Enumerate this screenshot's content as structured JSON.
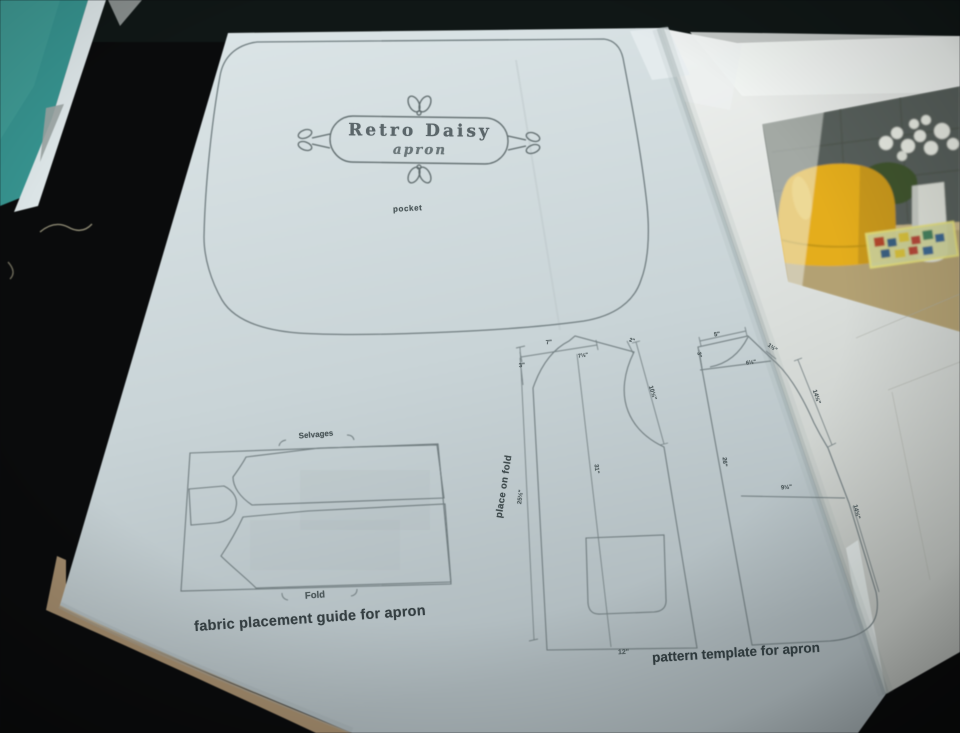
{
  "colors": {
    "teal_table": "#379490",
    "dark_cloth": "#0a0b0c",
    "page_paper": "#ccd7da",
    "right_page_paper": "#e6e9e6",
    "diagram_line": "#6d797c",
    "ink_text": "#39454a",
    "book_cover_tan": "#a89070",
    "bread_bin_yellow": "#e4ad1e",
    "photo_wall_grey": "#59605b",
    "photo_counter_tan": "#b3a173"
  },
  "page": {
    "label_frame": {
      "title": "Retro Daisy",
      "subtitle": "apron"
    },
    "pocket_piece": {
      "label": "pocket"
    },
    "fabric_guide": {
      "selvages": "Selvages",
      "fold": "Fold",
      "caption": "fabric placement guide for apron"
    },
    "template": {
      "caption": "pattern template for apron",
      "place_on_fold": "place on fold",
      "left_measurements": [
        "3\"",
        "7\"",
        "7½\"",
        "2\"",
        "10½\"",
        "31\"",
        "25½\"",
        "12\""
      ],
      "right_measurements": [
        "5\"",
        "3\"",
        "1½\"",
        "6½\"",
        "14½\"",
        "26\"",
        "9½\"",
        "14½\""
      ]
    }
  }
}
